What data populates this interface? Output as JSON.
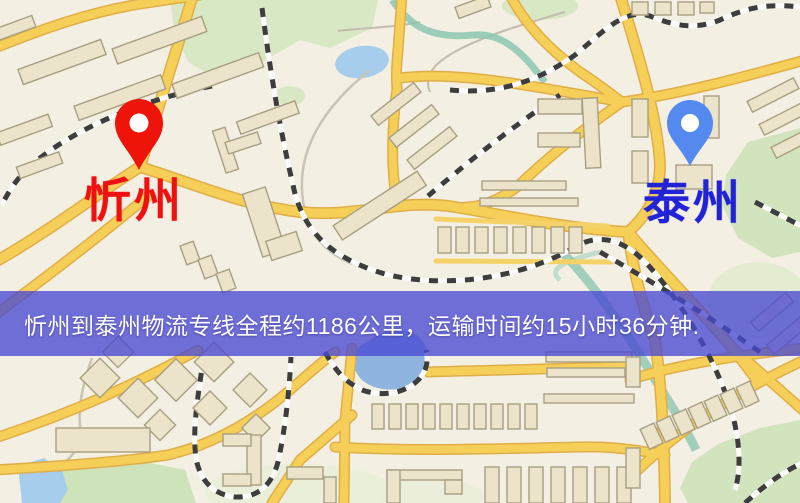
{
  "map": {
    "origin_marker": {
      "label": "忻州",
      "text_color": "#ee1111",
      "pin_color": "#ee1409"
    },
    "destination_marker": {
      "label": "泰州",
      "text_color": "#2323d6",
      "pin_color": "#548af0"
    },
    "banner": {
      "text": "忻州到泰州物流专线全程约1186公里，运输时间约15小时36分钟.",
      "text_color": "#ffffff",
      "background_color": "#4949d2"
    },
    "palette": {
      "land": "#f4efe3",
      "road_major_fill": "#f6cf58",
      "road_major_border": "#e0ae47",
      "building_fill": "#ebe4ca",
      "building_stroke": "#a89f80",
      "park_green": "#d9e8c4",
      "water_blue": "#a6cdec",
      "stream_teal": "#8cc7b2",
      "railway_dark": "#3d3d3d",
      "railway_light": "#fbfbfb"
    }
  }
}
